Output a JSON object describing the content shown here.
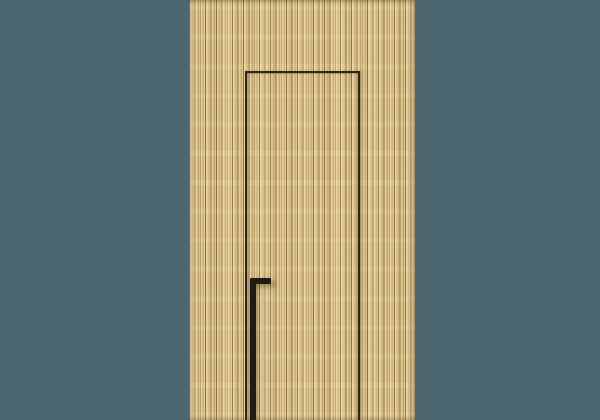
{
  "image": {
    "subject": "concealed-door-wood-slat-panel",
    "alt": "Concealed flush door within a light oak vertical slat wall panel with a slim black full-height handle on a teal wall"
  },
  "colors": {
    "wall": "#4c6770",
    "wood_base": "#dcc288",
    "wood_light": "#ecd9a6",
    "wood_light2": "#e4cd97",
    "wood_mid": "#c9ab70",
    "wood_groove": "#8a7347",
    "door_gap": "#2b2619",
    "handle": "#1f1c16"
  }
}
